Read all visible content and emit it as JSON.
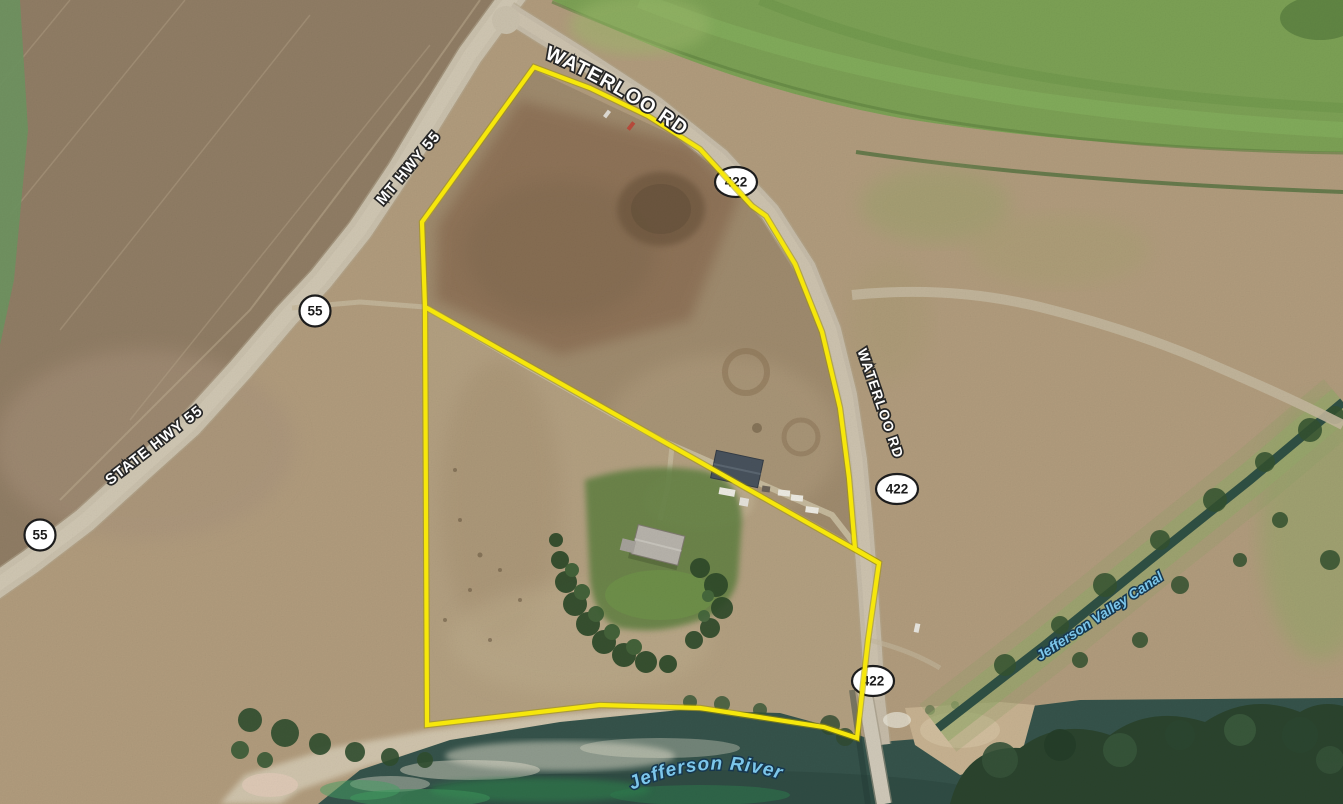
{
  "map": {
    "road_labels": [
      {
        "id": "waterloo-rd-top",
        "text": "WATERLOO RD"
      },
      {
        "id": "mt-hwy-55",
        "text": "MT HWY 55"
      },
      {
        "id": "state-hwy-55",
        "text": "STATE HWY 55"
      },
      {
        "id": "waterloo-rd-east",
        "text": "WATERLOO RD"
      }
    ],
    "route_shields": [
      {
        "route": "422"
      },
      {
        "route": "422"
      },
      {
        "route": "422"
      },
      {
        "route": "55"
      },
      {
        "route": "55"
      }
    ],
    "water_labels": [
      {
        "text": "Jefferson Valley Canal"
      },
      {
        "text": "Jefferson River"
      }
    ],
    "parcel_boundary_color": "#f6e70b",
    "colors": {
      "road_label_fill": "#ffffff",
      "water_label_fill": "#7cc6ea",
      "shield_background": "#ffffff",
      "shield_text": "#1b1b1b"
    }
  }
}
